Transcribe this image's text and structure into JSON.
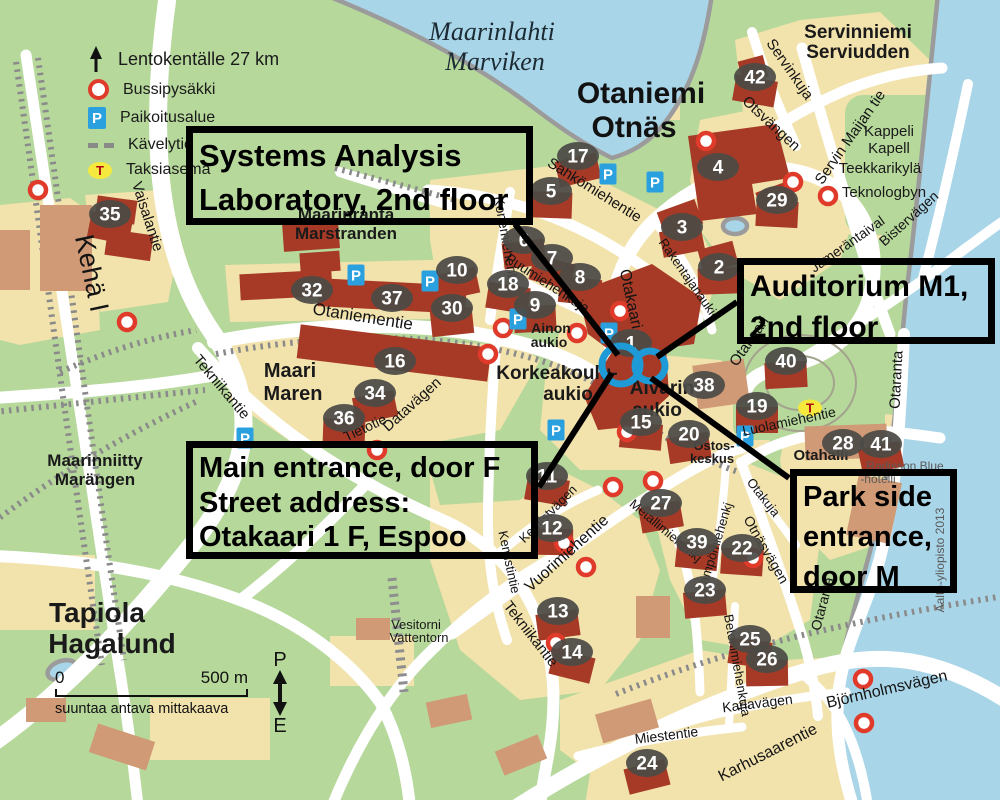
{
  "colors": {
    "water": "#a9d5e8",
    "land_green": "#b6d89b",
    "block_tan": "#f2e2ac",
    "building_red": "#a63a26",
    "building_light": "#cf9a75",
    "road": "#ffffff",
    "shoreline": "#9b9b9b",
    "marker_bg": "#4b4a46",
    "bus_stop_red": "#e03a2a",
    "parking_blue": "#2aa0df",
    "taxi_yellow": "#f6e93d",
    "taxi_letter": "#b00313",
    "entrance_blue": "#1e9ad6",
    "callout_border": "#000000"
  },
  "legend": {
    "distance_label": "Lentokentälle 27 km",
    "items": [
      {
        "name": "bus-stop",
        "label": "Bussipysäkki"
      },
      {
        "name": "parking",
        "label": "Paikoitusalue",
        "letter": "P"
      },
      {
        "name": "footpath",
        "label": "Kävelytie"
      },
      {
        "name": "taxi",
        "label": "Taksiasema",
        "letter": "T"
      }
    ]
  },
  "callouts": [
    {
      "id": "systems-analysis-lab",
      "lines": [
        "Systems Analysis",
        "Laboratory, 2nd floor"
      ],
      "leader": {
        "x1": 515,
        "y1": 224,
        "x2": 618,
        "y2": 355
      }
    },
    {
      "id": "auditorium-m1",
      "lines": [
        "Auditorium M1,",
        "2nd floor"
      ],
      "leader": {
        "x1": 737,
        "y1": 302,
        "x2": 657,
        "y2": 357
      }
    },
    {
      "id": "main-entrance",
      "lines": [
        "Main entrance, door F",
        "Street address:",
        "Otakaari 1 F, Espoo"
      ],
      "leader": {
        "x1": 539,
        "y1": 487,
        "x2": 612,
        "y2": 373
      }
    },
    {
      "id": "park-side-entrance",
      "lines": [
        "Park side",
        "entrance,",
        "door M"
      ],
      "leader": {
        "x1": 789,
        "y1": 478,
        "x2": 651,
        "y2": 378
      }
    }
  ],
  "entrance_circles": [
    {
      "cx": 621,
      "cy": 365,
      "r": 19
    },
    {
      "cx": 650,
      "cy": 366,
      "r": 15
    }
  ],
  "scale": {
    "zero": "0",
    "label": "500 m",
    "caption": "suuntaa antava mittakaava"
  },
  "compass": {
    "north": "P",
    "south": "E"
  },
  "place_labels": [
    [
      "Maarinlahti",
      492,
      40,
      26,
      "water"
    ],
    [
      "Marviken",
      495,
      70,
      26,
      "water"
    ],
    [
      "Otaniemi",
      641,
      103,
      30,
      "heavy"
    ],
    [
      "Otnäs",
      634,
      137,
      30,
      "heavy"
    ],
    [
      "Servinniemi",
      858,
      38,
      19,
      "bold"
    ],
    [
      "Serviudden",
      858,
      58,
      19,
      "bold"
    ],
    [
      "Maarinranta",
      346,
      220,
      17,
      "bold"
    ],
    [
      "Marstranden",
      346,
      239,
      17,
      "bold"
    ],
    [
      "Maari",
      290,
      377,
      20,
      "bold"
    ],
    [
      "Maren",
      293,
      400,
      20,
      "bold"
    ],
    [
      "Maarinniitty",
      95,
      466,
      17,
      "bold"
    ],
    [
      "Marängen",
      95,
      485,
      17,
      "bold"
    ],
    [
      "Tapiola",
      97,
      622,
      28,
      "bold"
    ],
    [
      "Hagalund",
      112,
      653,
      28,
      "bold"
    ],
    [
      "Korkeakoulu-",
      557,
      379,
      19,
      "bold"
    ],
    [
      "aukio",
      568,
      400,
      19,
      "bold"
    ],
    [
      "Alvarin",
      662,
      394,
      19,
      "bold"
    ],
    [
      "aukio",
      657,
      416,
      19,
      "bold"
    ],
    [
      "Ainon",
      551,
      333,
      14,
      "bold"
    ],
    [
      "aukio",
      549,
      347,
      14,
      "bold"
    ],
    [
      "Kappeli",
      889,
      136,
      15,
      "plain"
    ],
    [
      "Kapell",
      889,
      153,
      15,
      "plain"
    ],
    [
      "Teekkarikylä",
      880,
      173,
      15,
      "plain"
    ],
    [
      "Teknologbyn",
      884,
      197,
      15,
      "plain"
    ],
    [
      "Otahalli",
      821,
      460,
      15,
      "bold"
    ],
    [
      "Ostos-",
      714,
      450,
      13,
      "bold"
    ],
    [
      "keskus",
      712,
      463,
      13,
      "bold"
    ],
    [
      "Vesitorni",
      416,
      629,
      13,
      "plain"
    ],
    [
      "Vattentorn",
      419,
      642,
      13,
      "plain"
    ],
    [
      "Radisson Blue",
      905,
      470,
      12,
      "gray"
    ],
    [
      "-hotelli",
      878,
      483,
      12,
      "gray"
    ],
    [
      "Aalto-yliopisto 2013",
      944,
      560,
      12,
      "gray",
      -90
    ]
  ],
  "street_labels": [
    [
      "Kehä I",
      83,
      275,
      78,
      27
    ],
    [
      "Vaisalantie",
      143,
      218,
      72,
      15
    ],
    [
      "Tekniikantie",
      218,
      390,
      50,
      15
    ],
    [
      "Otaniementie",
      362,
      322,
      9,
      17
    ],
    [
      "Datavägen",
      415,
      408,
      -42,
      15
    ],
    [
      "Tietotie",
      367,
      432,
      -25,
      14
    ],
    [
      "Sähkömiehentie",
      592,
      194,
      32,
      15
    ],
    [
      "Konemiehentie",
      502,
      243,
      80,
      14
    ],
    [
      "Puumiehenkuja",
      545,
      287,
      33,
      14
    ],
    [
      "Otakaari",
      626,
      300,
      78,
      16
    ],
    [
      "Otakaari",
      753,
      344,
      -55,
      15
    ],
    [
      "Rakentajanaukio",
      686,
      282,
      55,
      13
    ],
    [
      "Otsvängen",
      768,
      127,
      43,
      15
    ],
    [
      "Servinkuja",
      786,
      72,
      55,
      15
    ],
    [
      "Servin Maijan tie",
      854,
      140,
      -55,
      15
    ],
    [
      "Jämeräntaival",
      850,
      248,
      -35,
      14
    ],
    [
      "Bistervägen",
      912,
      222,
      -42,
      14
    ],
    [
      "Luolamiehentie",
      790,
      426,
      -12,
      14
    ],
    [
      "Otaranta",
      901,
      380,
      -87,
      15
    ],
    [
      "Otaranta",
      827,
      605,
      -75,
      14
    ],
    [
      "Otakuja",
      760,
      500,
      52,
      13
    ],
    [
      "Otnäsvägen",
      762,
      552,
      60,
      14
    ],
    [
      "Vuorimiehentie",
      570,
      557,
      -42,
      16
    ],
    [
      "Kemistvägen",
      551,
      517,
      -45,
      13
    ],
    [
      "Kemistintie",
      505,
      563,
      78,
      13
    ],
    [
      "Metallimiehenkj",
      663,
      534,
      40,
      13
    ],
    [
      "Lämpömiehenkj",
      719,
      548,
      -73,
      13
    ],
    [
      "Tekniikantie",
      527,
      637,
      52,
      15
    ],
    [
      "Betonimiehenkuja",
      733,
      666,
      80,
      13
    ],
    [
      "Karlavägen",
      758,
      708,
      -7,
      14
    ],
    [
      "Miestentie",
      667,
      740,
      -7,
      14
    ],
    [
      "Karhusaarentie",
      770,
      757,
      -27,
      16
    ],
    [
      "Björnholmsvägen",
      888,
      694,
      -13,
      16
    ]
  ],
  "markers": [
    [
      42,
      755,
      77
    ],
    [
      17,
      578,
      156
    ],
    [
      5,
      551,
      191
    ],
    [
      4,
      718,
      167
    ],
    [
      29,
      777,
      200
    ],
    [
      35,
      110,
      214
    ],
    [
      3,
      682,
      227
    ],
    [
      2,
      719,
      267
    ],
    [
      6,
      524,
      240
    ],
    [
      7,
      552,
      258
    ],
    [
      8,
      580,
      277
    ],
    [
      10,
      457,
      270
    ],
    [
      18,
      508,
      284
    ],
    [
      9,
      535,
      305
    ],
    [
      30,
      452,
      308
    ],
    [
      32,
      312,
      290
    ],
    [
      37,
      392,
      298
    ],
    [
      16,
      395,
      361
    ],
    [
      34,
      375,
      393
    ],
    [
      36,
      344,
      418
    ],
    [
      1,
      631,
      343
    ],
    [
      38,
      704,
      385
    ],
    [
      15,
      641,
      422
    ],
    [
      20,
      689,
      434
    ],
    [
      19,
      757,
      406
    ],
    [
      40,
      786,
      361
    ],
    [
      28,
      843,
      443
    ],
    [
      41,
      881,
      444
    ],
    [
      11,
      547,
      476
    ],
    [
      12,
      552,
      528
    ],
    [
      27,
      661,
      503
    ],
    [
      39,
      697,
      542
    ],
    [
      23,
      705,
      590
    ],
    [
      22,
      742,
      548
    ],
    [
      13,
      558,
      611
    ],
    [
      14,
      572,
      652
    ],
    [
      25,
      750,
      639
    ],
    [
      26,
      767,
      659
    ],
    [
      24,
      647,
      763
    ]
  ],
  "bus_stops": [
    [
      38,
      190
    ],
    [
      127,
      322
    ],
    [
      503,
      328
    ],
    [
      577,
      333
    ],
    [
      488,
      354
    ],
    [
      620,
      311
    ],
    [
      627,
      432
    ],
    [
      653,
      481
    ],
    [
      613,
      487
    ],
    [
      564,
      543
    ],
    [
      586,
      567
    ],
    [
      556,
      643
    ],
    [
      706,
      141
    ],
    [
      793,
      182
    ],
    [
      828,
      196
    ],
    [
      863,
      679
    ],
    [
      864,
      723
    ],
    [
      377,
      450
    ],
    [
      753,
      558
    ]
  ],
  "parking": [
    [
      356,
      275
    ],
    [
      430,
      281
    ],
    [
      518,
      319
    ],
    [
      608,
      174
    ],
    [
      655,
      182
    ],
    [
      609,
      333
    ],
    [
      556,
      430
    ],
    [
      745,
      436
    ],
    [
      245,
      438
    ]
  ],
  "taxi": [
    [
      810,
      408
    ]
  ]
}
